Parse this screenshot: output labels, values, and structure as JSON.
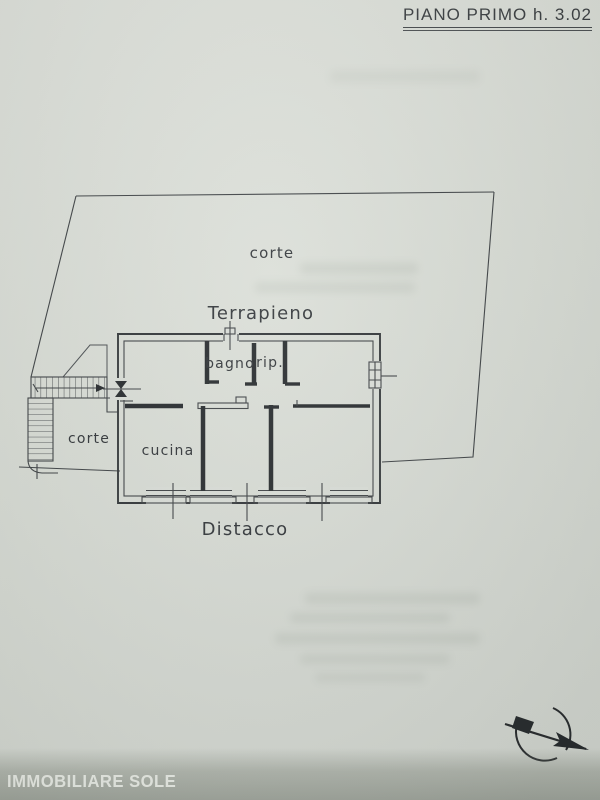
{
  "document": {
    "title": "PIANO PRIMO h. 3.02",
    "watermark": "IMMOBILIARE SOLE"
  },
  "plan": {
    "rooms": {
      "corte_upper": "corte",
      "terrapieno": "Terrapieno",
      "bagno": "bagno",
      "rip": "rip.",
      "cucina": "cucina",
      "corte_lower": "corte",
      "distacco": "Distacco"
    },
    "icons": {
      "north_arrow": "circle-with-se-arrow"
    },
    "colors": {
      "paper": "#d9ddd6",
      "ink": "#34383b",
      "watermark_band": "#767d71",
      "watermark_text": "#edf0ea"
    }
  }
}
